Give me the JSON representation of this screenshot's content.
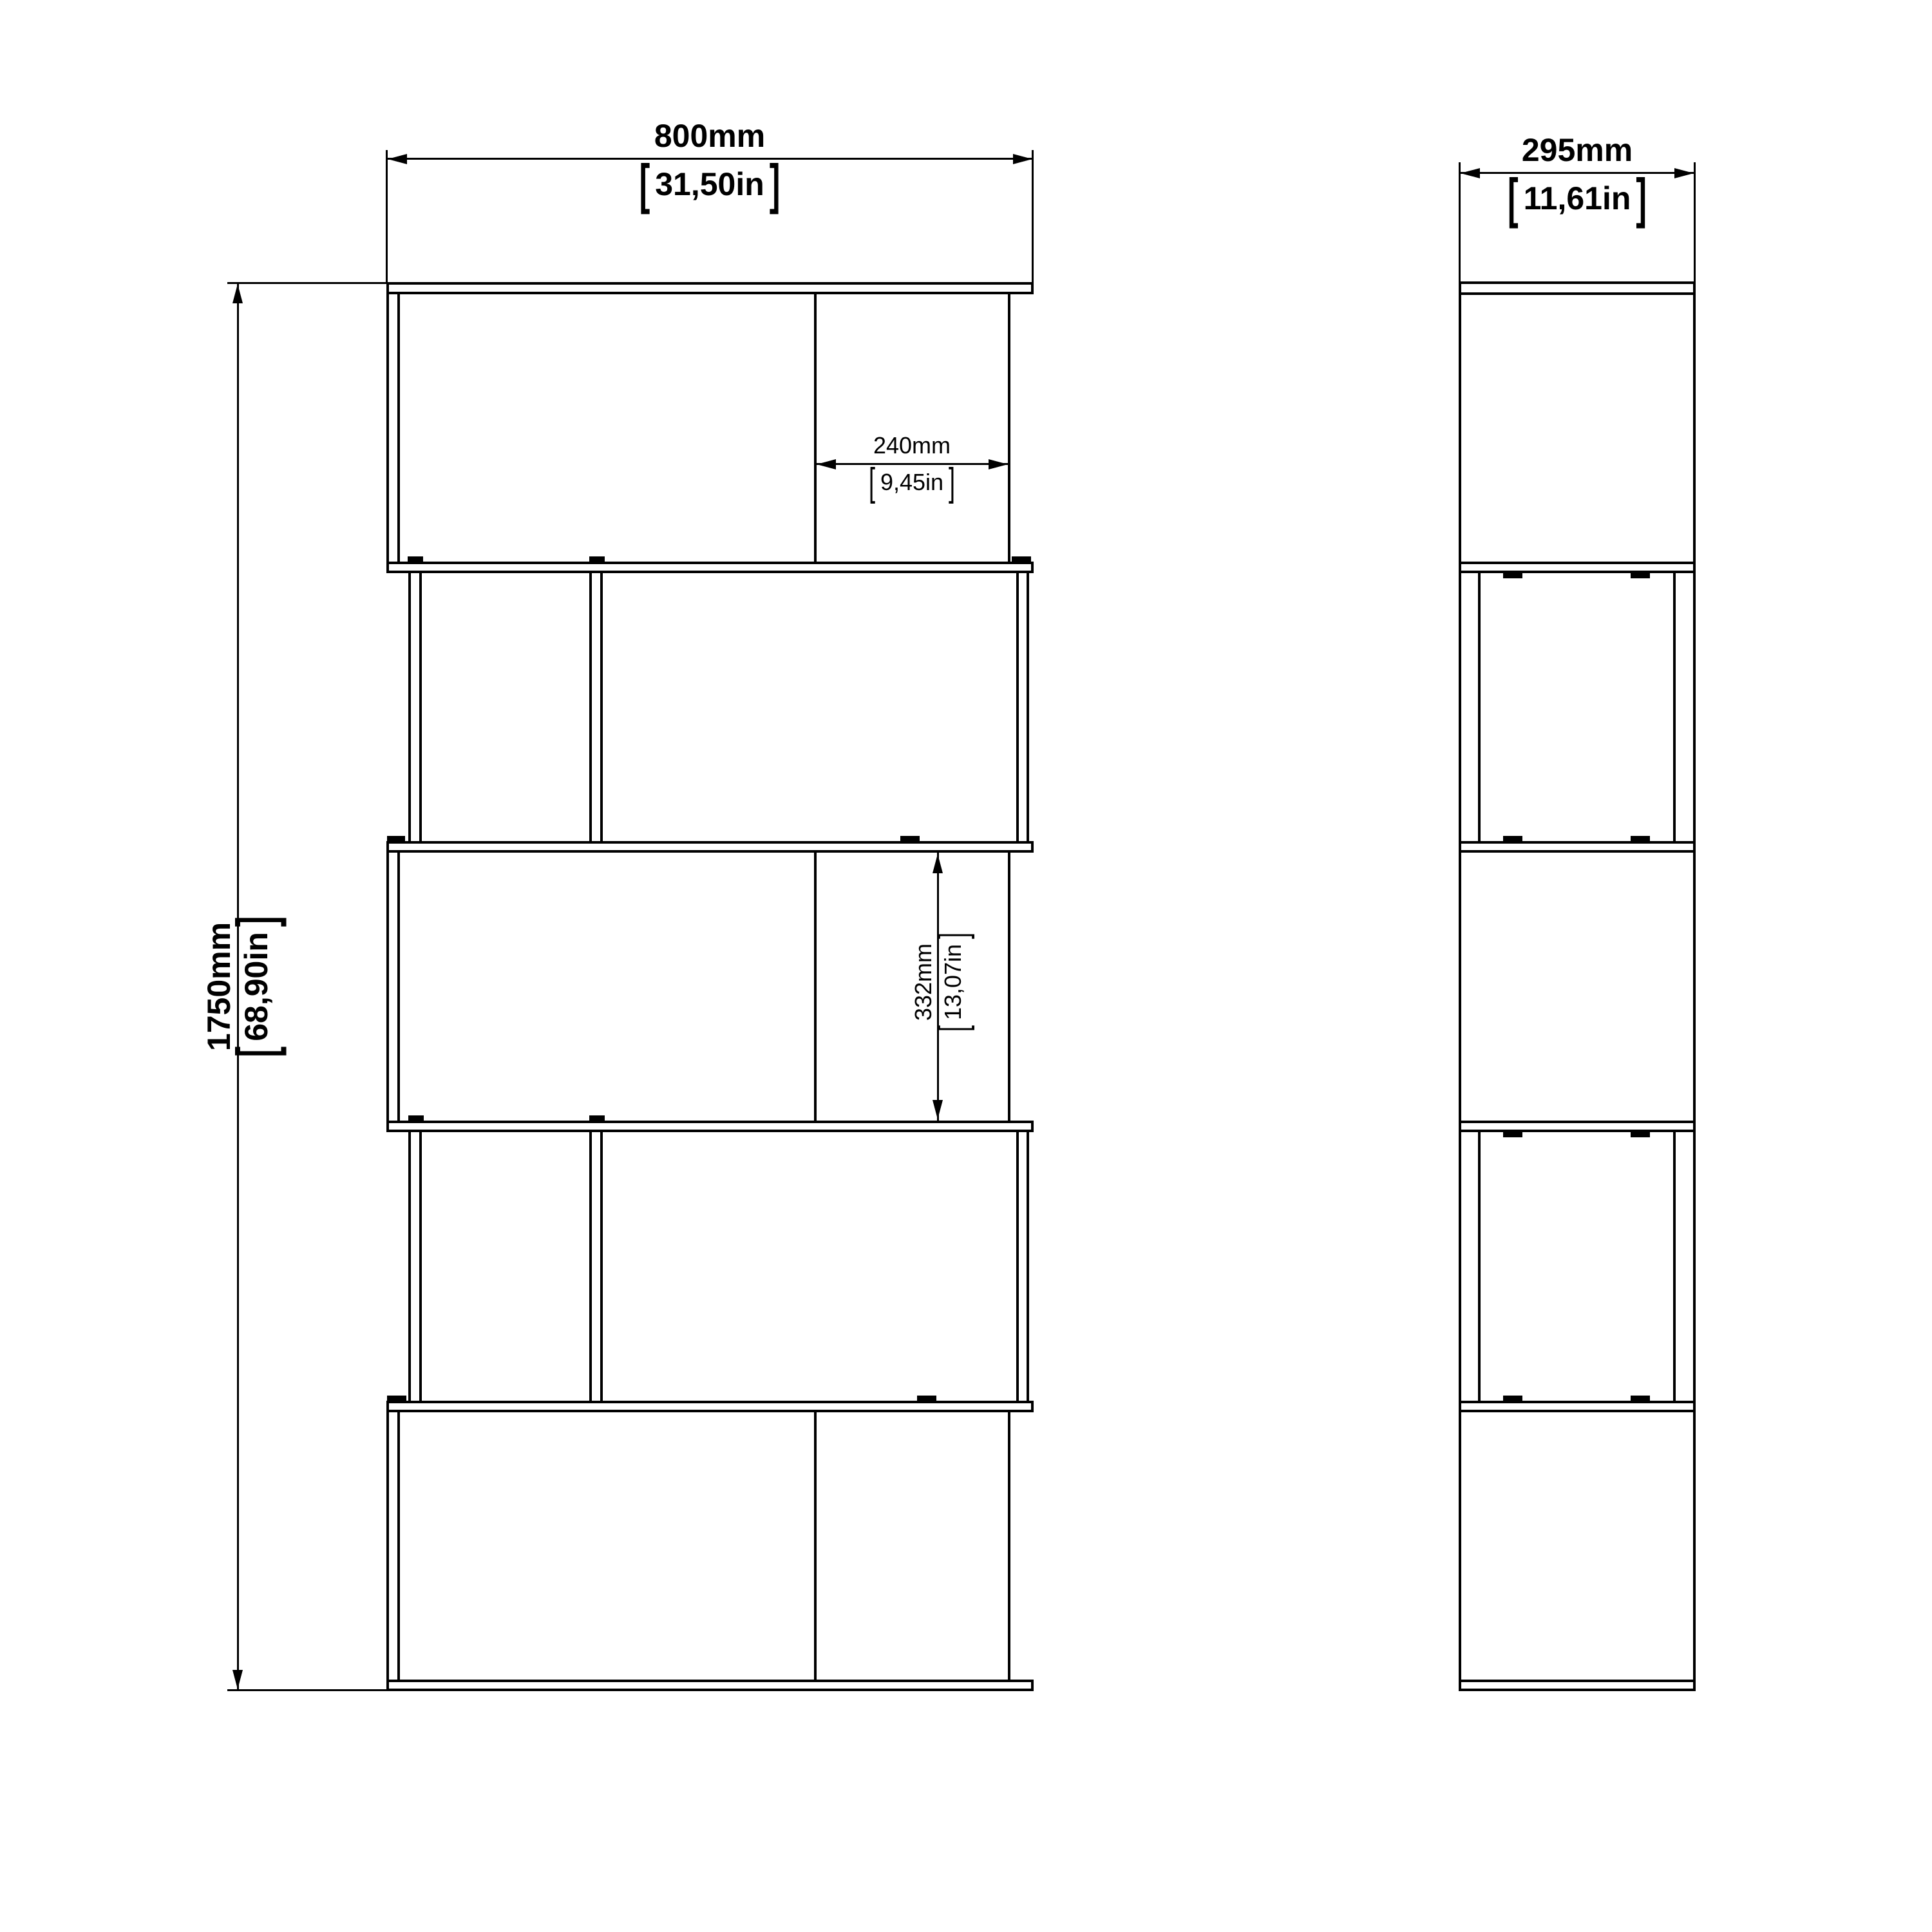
{
  "drawing": {
    "type": "furniture technical drawing",
    "line_color": "#000000",
    "background_color": "#ffffff",
    "views": {
      "front_view": {
        "rows": 5,
        "dividers_per_row": 1,
        "layout": "staggered zig-zag bookcase"
      },
      "side_view": {
        "sections": 5
      }
    }
  },
  "dimensions": {
    "bracket_open": "[",
    "bracket_close": "]",
    "overall_width": {
      "mm": "800mm",
      "inch": "31,50in"
    },
    "overall_height": {
      "mm": "1750mm",
      "inch": "68,90in"
    },
    "depth": {
      "mm": "295mm",
      "inch": "11,61in"
    },
    "inner_width": {
      "mm": "240mm",
      "inch": "9,45in"
    },
    "inner_height": {
      "mm": "332mm",
      "inch": "13,07in"
    }
  }
}
